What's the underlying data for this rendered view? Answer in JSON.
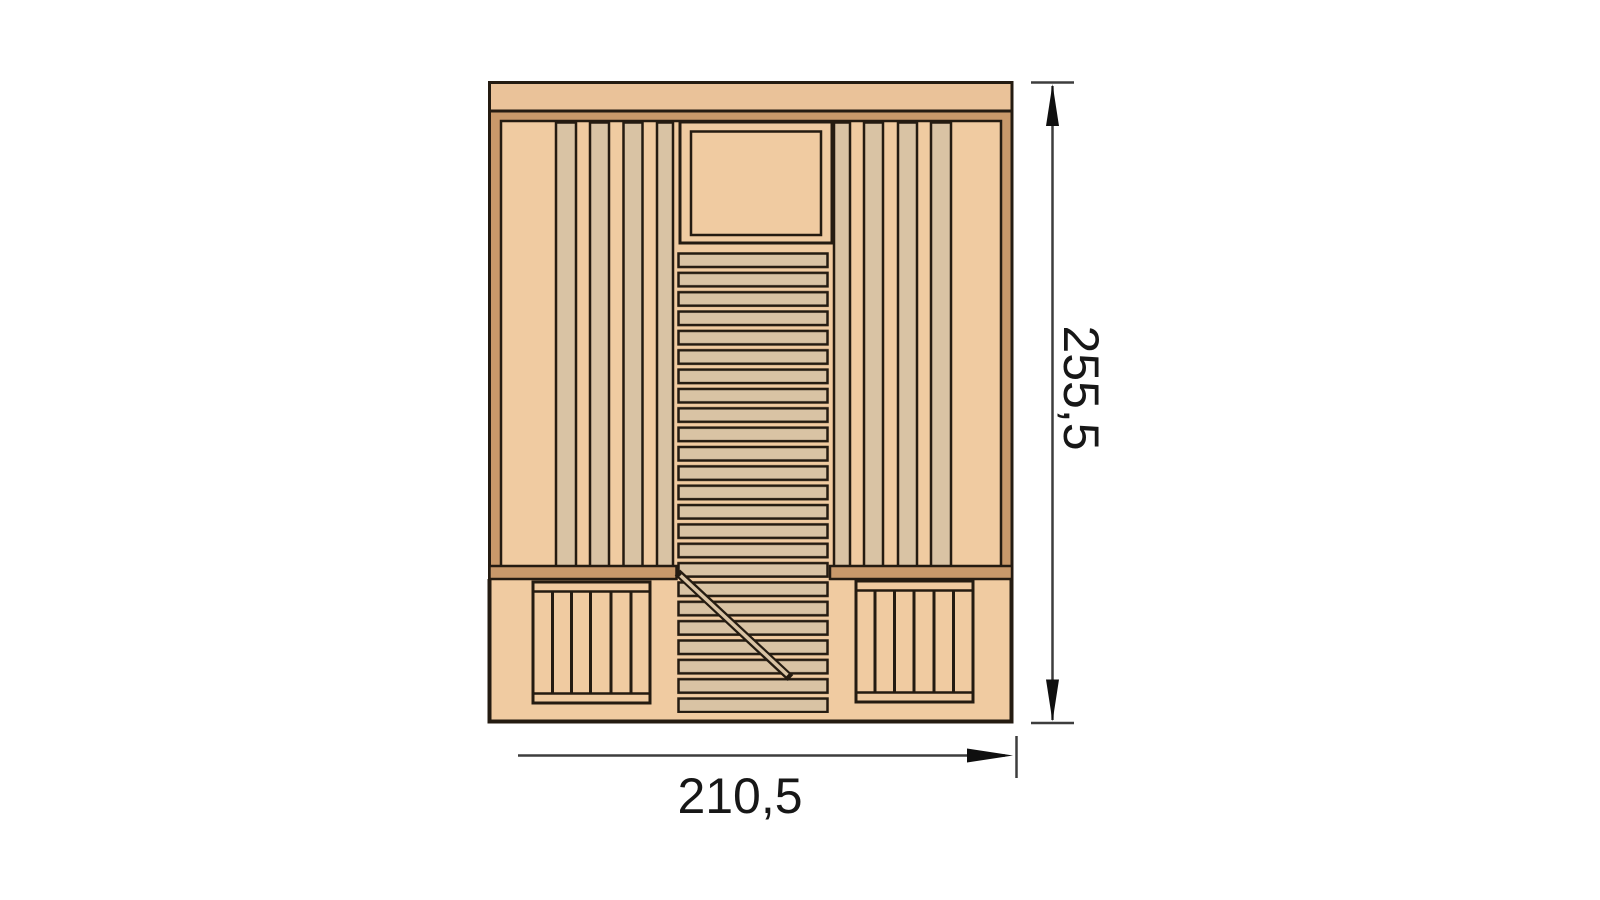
{
  "page": {
    "background": "#ffffff"
  },
  "diagram": {
    "title": "Sauna cabin floor plan, top view",
    "type": "technical-drawing",
    "colors": {
      "outline": "#241b11",
      "wall_fill": "#c9996a",
      "floor_fill": "#f0cba1",
      "board_fill": "#d9c3a4",
      "top_band_fill": "#eac299",
      "dimension_line": "#3d3d3d",
      "dimension_text": "#171717"
    },
    "dimensions": {
      "height": {
        "label": "255,5",
        "side": "right",
        "orientation": "vertical"
      },
      "width": {
        "label": "210,5",
        "side": "bottom",
        "orientation": "horizontal"
      }
    }
  }
}
